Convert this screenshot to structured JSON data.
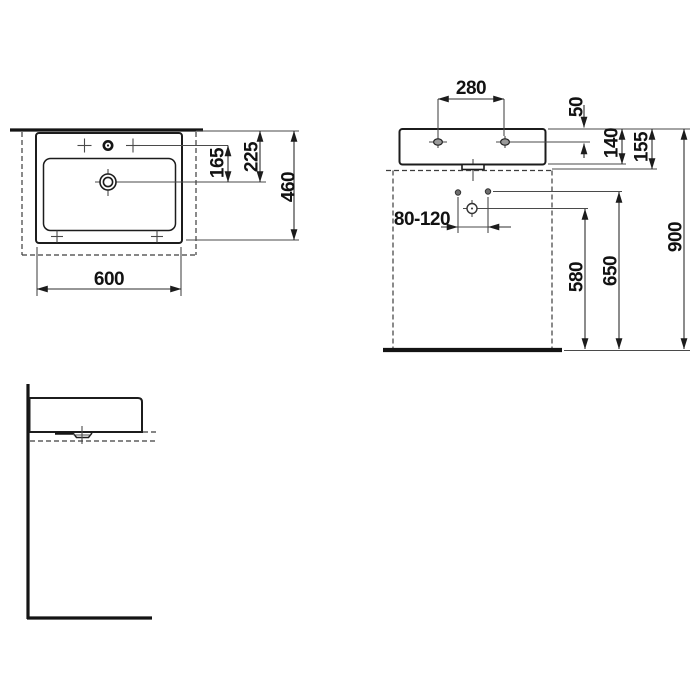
{
  "drawing": {
    "title": "Wall-mounted washbasin technical dimension drawing",
    "views": [
      "plan-view",
      "front-view",
      "side-view"
    ],
    "units": "mm"
  },
  "colors": {
    "line": "#1c1c1c",
    "thin_line": "#4a4a4a",
    "background": "#ffffff"
  },
  "views": {
    "plan": {
      "dims": {
        "width": "600",
        "depth": "460",
        "tap_to_drain": "165",
        "rim_to_drain": "225"
      }
    },
    "front": {
      "dims": {
        "tap_hole_spacing": "280",
        "rim_to_tap_hole": "50",
        "height_140": "140",
        "height_155": "155",
        "drain_height_range": "80-120",
        "floor_to_drain": "580",
        "floor_to_holes": "650",
        "floor_to_rim": "900"
      }
    },
    "side": {
      "dims": {}
    }
  }
}
